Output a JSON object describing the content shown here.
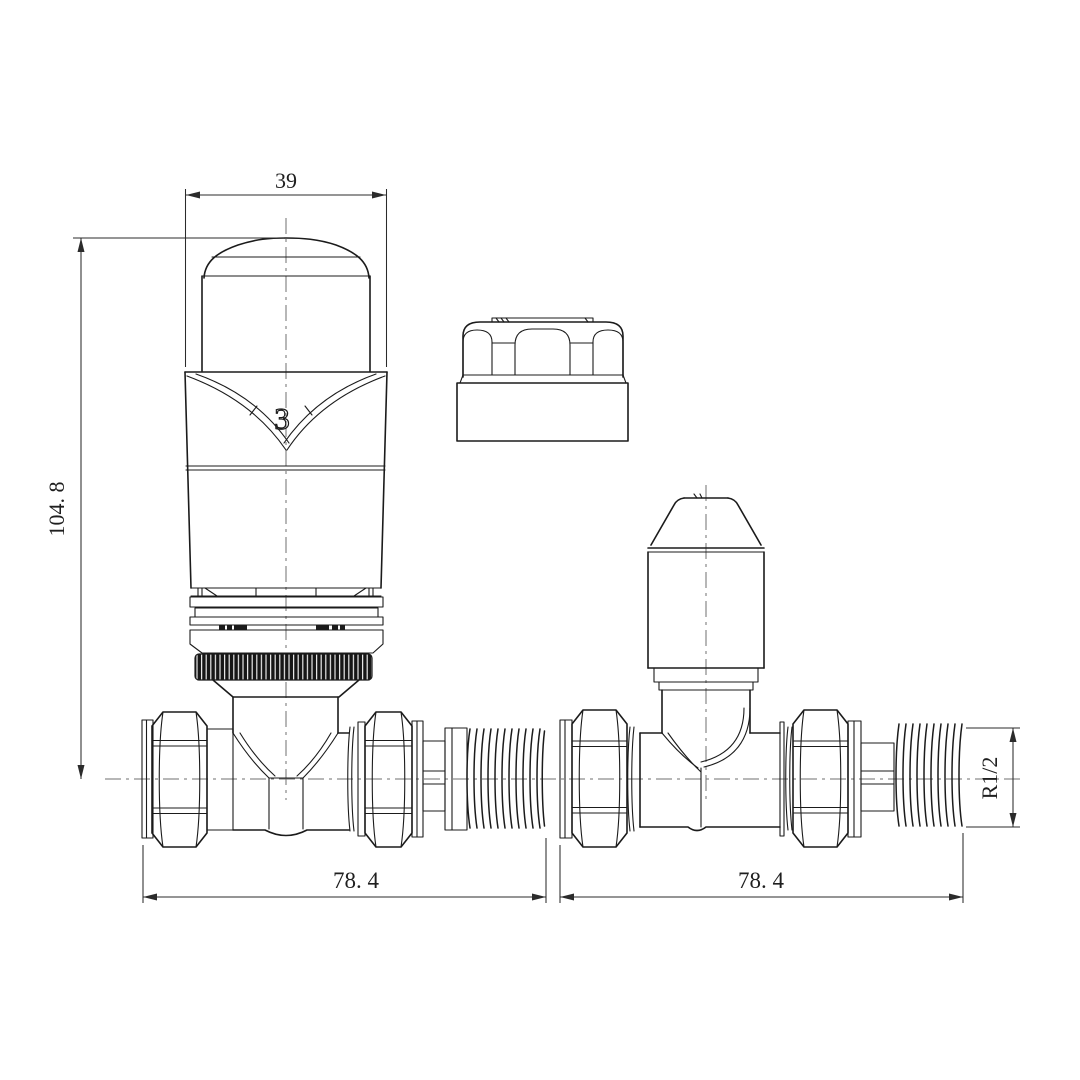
{
  "drawing": {
    "background": "#ffffff",
    "line_color": "#1b1b1b",
    "centerline_color": "#6f6f6f",
    "dimension_color": "#2b2b2b",
    "knurl_fill": "#161616",
    "labels": {
      "head_width": "39",
      "overall_height": "104. 8",
      "left_valve_length": "78. 4",
      "right_valve_length": "78. 4",
      "tail_thread": "R1/2",
      "head_setting": "3"
    },
    "parts": {
      "left_assembly": "thermostatic-radiator-valve-front-view",
      "center_part": "manual-cap-front-view",
      "right_assembly": "lockshield-valve-front-view"
    }
  }
}
